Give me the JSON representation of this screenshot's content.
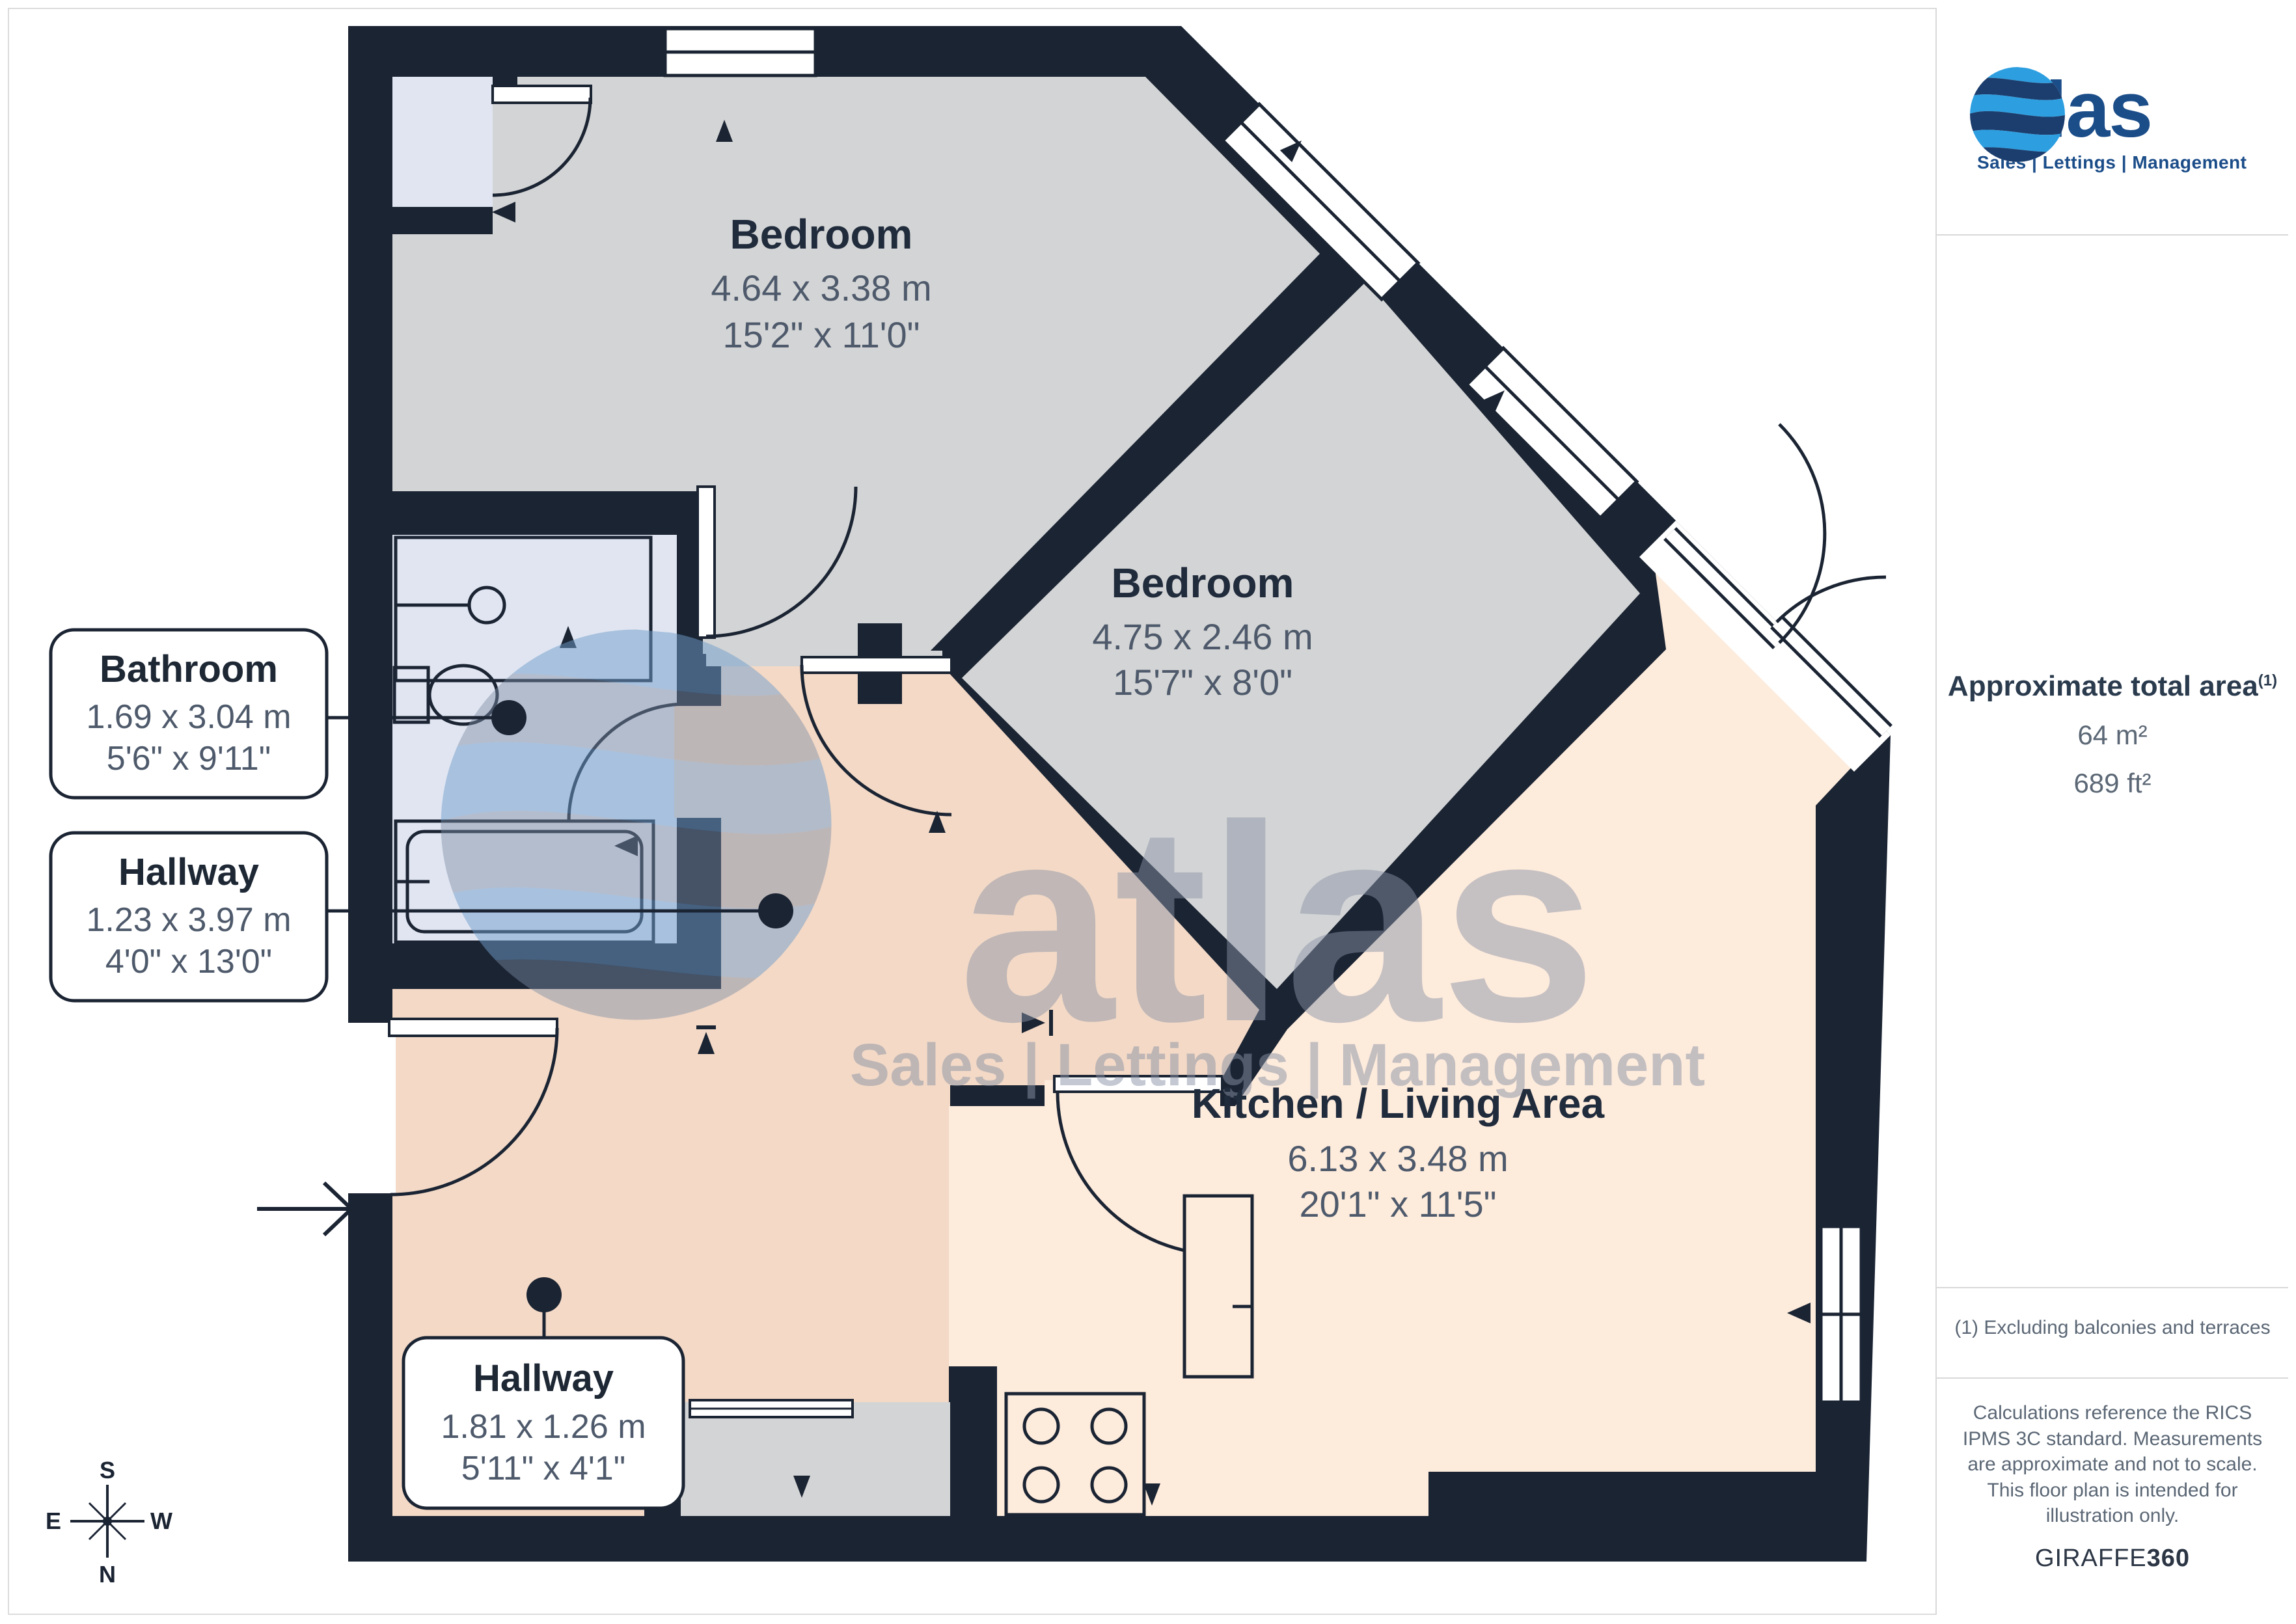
{
  "watermark": {
    "brand": "atlas",
    "tagline": "Sales | Lettings | Management"
  },
  "plan": {
    "rooms": {
      "bedroom1": {
        "name": "Bedroom",
        "metric": "4.64 x 3.38 m",
        "imperial": "15'2\" x 11'0\""
      },
      "bedroom2": {
        "name": "Bedroom",
        "metric": "4.75 x 2.46 m",
        "imperial": "15'7\" x 8'0\""
      },
      "kitchen_living": {
        "name": "Kitchen / Living Area",
        "metric": "6.13 x 3.48 m",
        "imperial": "20'1\" x 11'5\""
      }
    },
    "callouts": {
      "bathroom": {
        "name": "Bathroom",
        "metric": "1.69 x 3.04 m",
        "imperial": "5'6\" x 9'11\""
      },
      "hallway1": {
        "name": "Hallway",
        "metric": "1.23 x 3.97 m",
        "imperial": "4'0\" x 13'0\""
      },
      "hallway2": {
        "name": "Hallway",
        "metric": "1.81 x 1.26 m",
        "imperial": "5'11\" x 4'1\""
      }
    },
    "compass": {
      "north": "N",
      "south": "S",
      "east": "E",
      "west": "W"
    }
  },
  "sidebar": {
    "logo": {
      "brand": "atlas",
      "tagline": "Sales | Lettings | Management"
    },
    "area": {
      "title": "Approximate total area",
      "footnote_marker": "(1)",
      "metric": "64 m²",
      "imperial": "689 ft²"
    },
    "footnote": "(1) Excluding balconies and terraces",
    "disclaimer": "Calculations reference the RICS IPMS 3C standard. Measurements are approximate and not to scale. This floor plan is intended for illustration only.",
    "credit": {
      "brand": "GIRAFFE",
      "suffix": "360"
    }
  },
  "colors": {
    "wall": "#1b2433",
    "bedroom_fill": "#d3d4d5",
    "bathroom_fill": "#e0e5f1",
    "hallway_fill": "#f3d9c6",
    "kitchen_fill": "#fdebdc",
    "brand_blue": "#1b4d89",
    "logo_light_blue": "#2d9fe0",
    "text_gray": "#5b6775",
    "title_navy": "#202b3c"
  }
}
